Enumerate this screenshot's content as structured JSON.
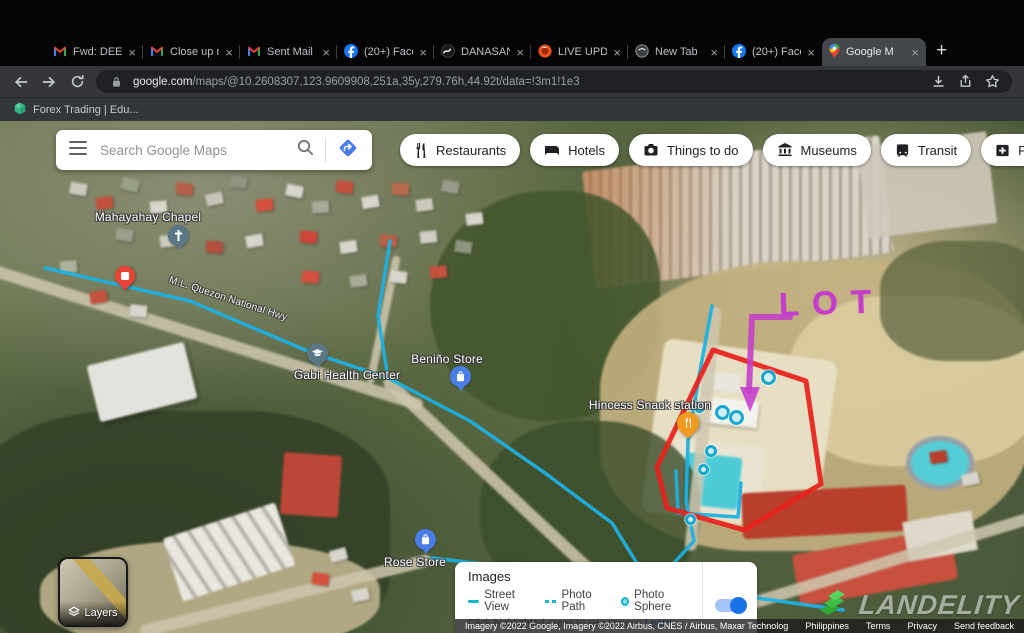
{
  "browser": {
    "tabs": [
      {
        "label": "Fwd: DEED"
      },
      {
        "label": "Close up m"
      },
      {
        "label": "Sent Mail -"
      },
      {
        "label": "(20+) Face"
      },
      {
        "label": "DANASAN"
      },
      {
        "label": "LIVE UPDA"
      },
      {
        "label": "New Tab"
      },
      {
        "label": "(20+) Face"
      },
      {
        "label": "Google M"
      }
    ],
    "tab_close_glyph": "×",
    "new_tab_glyph": "+",
    "url_domain": "google.com",
    "url_path": "/maps/@10.2608307,123.9609908,251a,35y,279.76h,44.92t/data=!3m1!1e3",
    "bookmark_label": "Forex Trading | Edu..."
  },
  "maps_ui": {
    "search_placeholder": "Search Google Maps",
    "chips": [
      "Restaurants",
      "Hotels",
      "Things to do",
      "Museums",
      "Transit",
      "Pharmacies",
      "ATMs"
    ],
    "atm_glyph": "$",
    "layers_label": "Layers",
    "legend": {
      "title": "Images",
      "street_view": "Street View",
      "photo_path": "Photo Path",
      "photo_sphere": "Photo Sphere",
      "hint": "Click highlighted areas to see images",
      "link": "Learn more"
    },
    "attribution": "Imagery ©2022 Google, Imagery ©2022 Airbus, CNES / Airbus, Maxar Technologies, Map data ©2022",
    "footer_links": [
      "Philippines",
      "Terms",
      "Privacy",
      "Send feedback"
    ]
  },
  "map": {
    "labels": {
      "chapel": "Mahayahay Chapel",
      "health": "Gabi Health Center",
      "benino": "Beniño Store",
      "hincess": "Hincess Snack station",
      "rose": "Rose Store",
      "road": "M.L. Quezon National Hwy"
    },
    "annotation_text": "LOT",
    "annotation_color": "#c43ecb",
    "lot_outline_color": "#e8211c",
    "street_view_color": "#1fb0e0",
    "watermark": "LANDELITY"
  }
}
